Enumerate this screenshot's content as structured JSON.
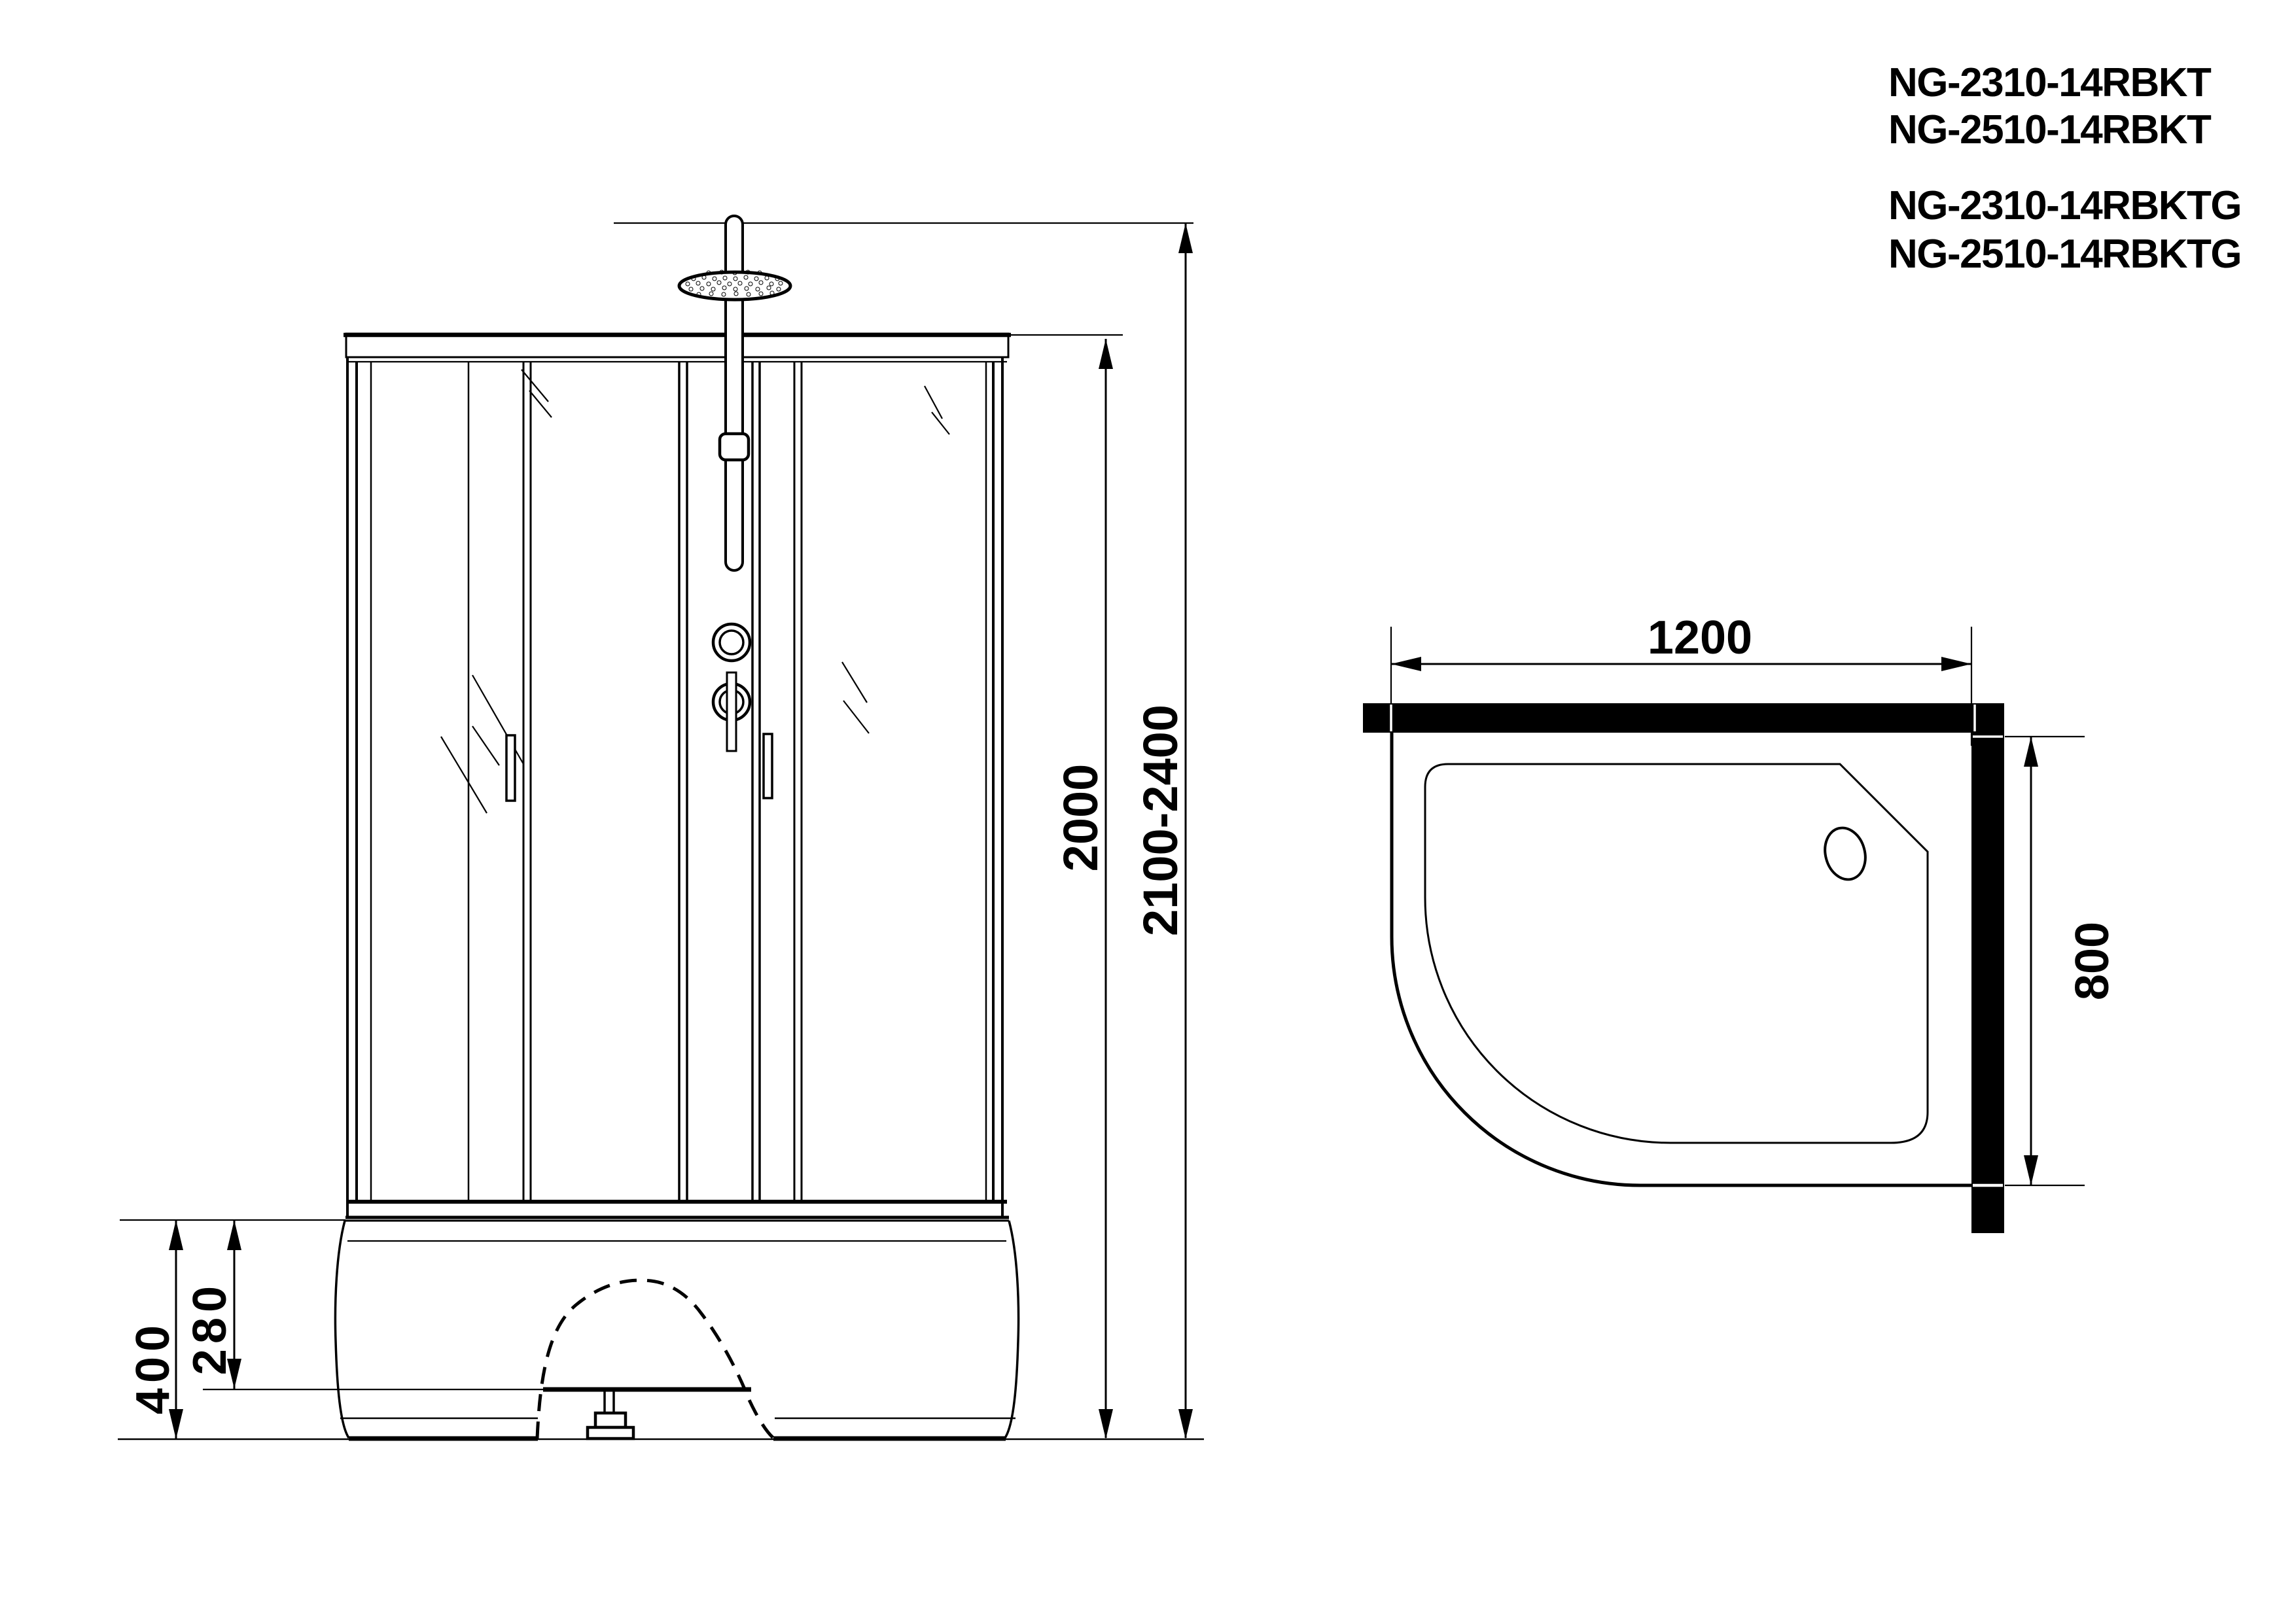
{
  "document": {
    "background": "#ffffff",
    "ink": "#000000",
    "type": "technical-drawing"
  },
  "model_numbers": {
    "line1": "NG-2310-14RBKT",
    "line2": "NG-2510-14RBKT",
    "line3": "NG-2310-14RBKTG",
    "line4": "NG-2510-14RBKTG"
  },
  "front_view": {
    "dimensions": {
      "cabin_height": "2000",
      "overall_height": "2100-2400",
      "tray_height": "400",
      "tray_upper_height": "280"
    }
  },
  "plan_view": {
    "dimensions": {
      "width": "1200",
      "depth": "800"
    }
  }
}
